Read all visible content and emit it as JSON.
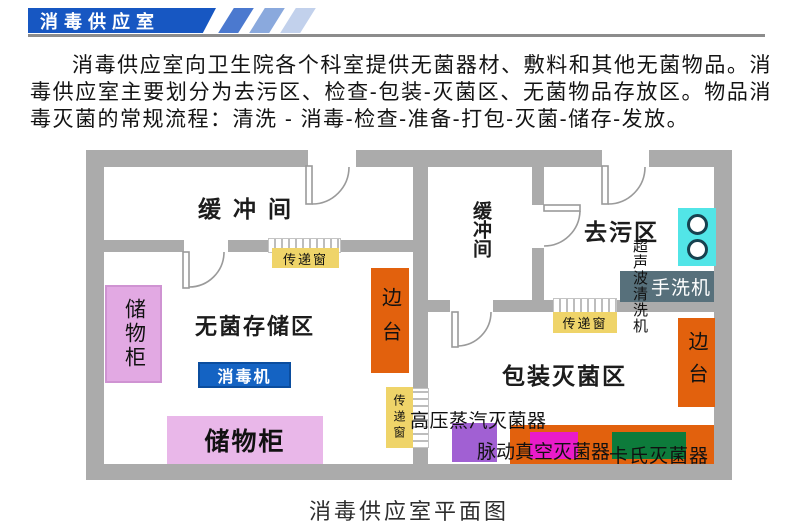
{
  "header": {
    "title": "消毒供应室"
  },
  "intro": {
    "text": "消毒供应室向卫生院各个科室提供无菌器材、敷料和其他无菌物品。消毒供应室主要划分为去污区、检查-包装-灭菌区、无菌物品存放区。物品消毒灭菌的常规流程：清洗 - 消毒-检查-准备-打包-灭菌-储存-发放。"
  },
  "plan": {
    "labels": {
      "buffer_top": "缓冲间",
      "buffer_mid": "缓冲间",
      "decontamination": "去污区",
      "sterile_storage": "无菌存储区",
      "packing_sterilization": "包装灭菌区",
      "cabinet_left": "储物柜",
      "cabinet_bottom": "储物柜",
      "disinfector": "消毒机",
      "side_table_left": "边台",
      "side_table_right": "边台",
      "pass_window_top": "传递窗",
      "pass_window_mid": "传递窗",
      "pass_window_vertical": "传递窗",
      "ultrasonic_cleaner": "超声波清洗机",
      "hand_washer": "手洗机",
      "autoclave": "高压蒸汽灭菌器",
      "pulse_vacuum_sterilizer": "脉动真空灭菌器",
      "cassette_sterilizer": "卡氏灭菌器"
    }
  },
  "caption": {
    "text": "消毒供应室平面图"
  },
  "colors": {
    "banner_blue": "#1757c2",
    "stripe_blues": [
      "#4b79cf",
      "#8aa9dd",
      "#c2d1ec"
    ],
    "wall_gray": "#ababab",
    "cabinet_pink": "#e2a9e3",
    "disinfector_blue": "#1463c3",
    "side_table_orange": "#e2610d",
    "pass_window_yellow": "#efd469",
    "ultrasonic_cyan": "#52e5e7",
    "hand_washer_slate": "#57707b",
    "autoclave_purple": "#a160d3",
    "pulse_magenta": "#ea1bc9",
    "cassette_green": "#0d7b3b"
  }
}
